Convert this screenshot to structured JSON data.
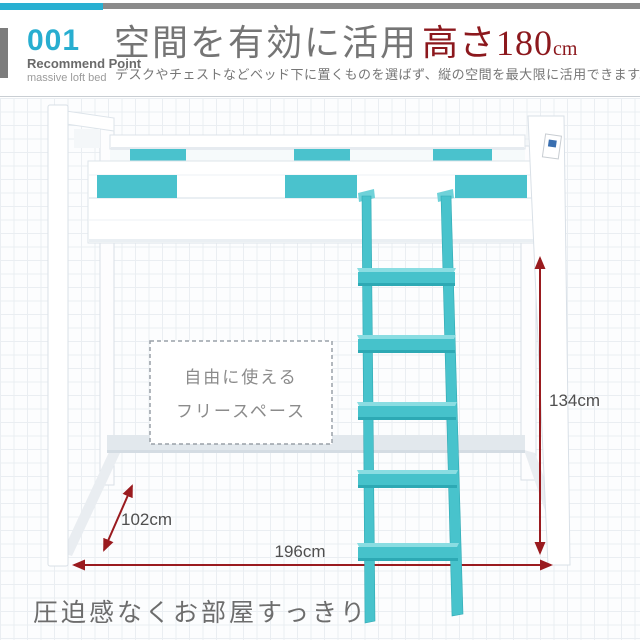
{
  "header": {
    "index_number": "001",
    "point_label": "Recommend Point",
    "point_sublabel": "massive loft bed",
    "title": "空間を有効に活用",
    "title_highlight": "高さ180",
    "title_unit": "cm",
    "description": "デスクやチェストなどベッド下に置くものを選ばず、縦の空間を最大限に活用できます。"
  },
  "figure": {
    "free_space_box": {
      "line1": "自由に使える",
      "line2": "フリースペース"
    },
    "dimensions": {
      "height": "134cm",
      "depth": "102cm",
      "width": "196cm"
    }
  },
  "caption": "圧迫感なくお部屋すっきり",
  "colors": {
    "accent_cyan": "#28b0d2",
    "bed_teal": "#4ac2cd",
    "dimension_red": "#9a1b1f",
    "title_red": "#8c181d"
  }
}
